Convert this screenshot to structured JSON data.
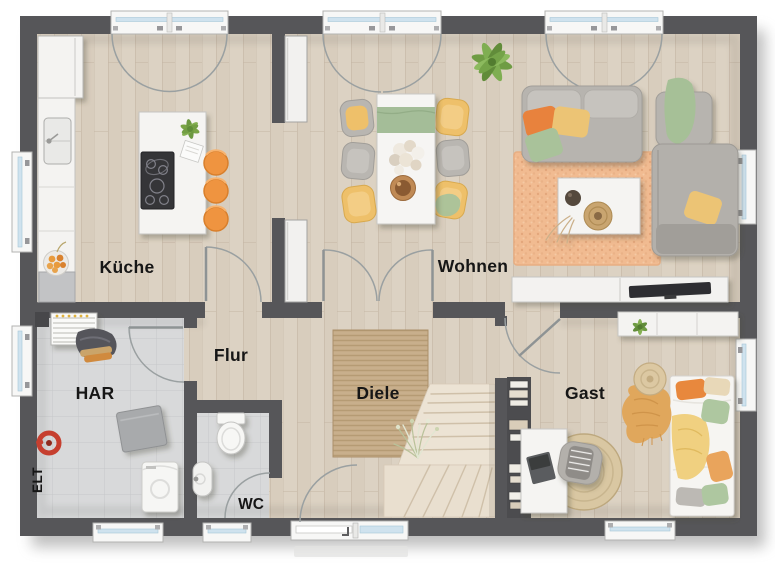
{
  "page": {
    "type": "floor-plan",
    "background": "#ffffff"
  },
  "rooms": {
    "kueche": {
      "label": "Küche"
    },
    "wohnen": {
      "label": "Wohnen"
    },
    "flur": {
      "label": "Flur"
    },
    "diele": {
      "label": "Diele"
    },
    "har": {
      "label": "HAR"
    },
    "wc": {
      "label": "WC"
    },
    "gast": {
      "label": "Gast"
    },
    "elt": {
      "label": "ELT"
    }
  },
  "colors": {
    "wall": "#565659",
    "wood_floor": "#dcd2c3",
    "tile_floor": "#d8d9da",
    "accent_orange": "#ef9440",
    "accent_yellow": "#ecc474",
    "accent_green": "#a9c29a",
    "rug_peach": "#f1bb91",
    "rug_jute": "#c4aa86",
    "stair_wood": "#ece3d4"
  }
}
